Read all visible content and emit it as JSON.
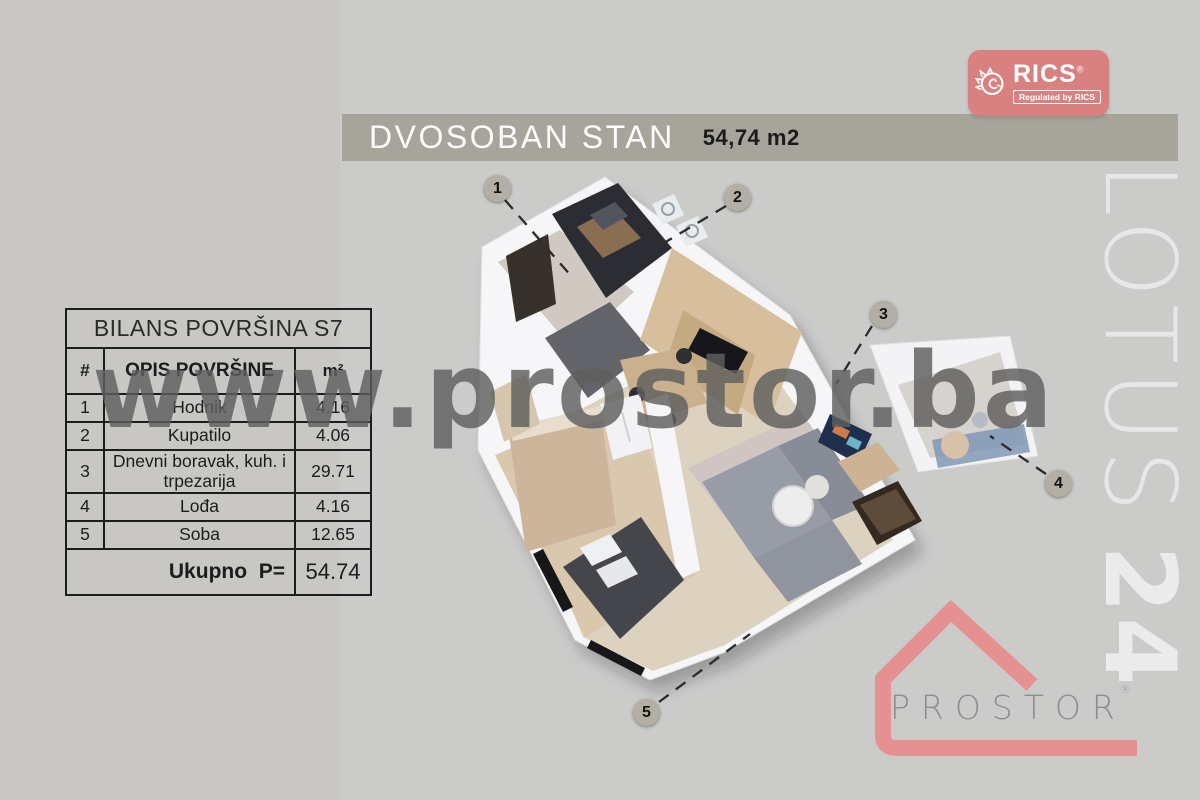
{
  "title_bar": {
    "title": "DVOSOBAN STAN",
    "area": "54,74 m2",
    "bar_color": "#a7a49c"
  },
  "rics_badge": {
    "brand": "RICS",
    "registered_mark": "®",
    "tagline": "Regulated by RICS",
    "color": "#d98181"
  },
  "watermark": {
    "text": "www.prostor.ba"
  },
  "side_label": {
    "word": "LOTUS",
    "number": "24"
  },
  "balance_table": {
    "title": "BILANS POVRŠINA S7",
    "columns": {
      "num": "#",
      "desc": "OPIS POVRŠINE",
      "unit": "m²"
    },
    "rows": [
      {
        "num": "1",
        "desc": "Hodnik",
        "value": "4.16"
      },
      {
        "num": "2",
        "desc": "Kupatilo",
        "value": "4.06"
      },
      {
        "num": "3",
        "desc": "Dnevni boravak, kuh. i trpezarija",
        "value": "29.71"
      },
      {
        "num": "4",
        "desc": "Lođa",
        "value": "4.16"
      },
      {
        "num": "5",
        "desc": "Soba",
        "value": "12.65"
      }
    ],
    "total_label": "Ukupno  P=",
    "total_value": "54.74"
  },
  "floor_plan": {
    "markers": [
      {
        "label": "1"
      },
      {
        "label": "2"
      },
      {
        "label": "3"
      },
      {
        "label": "4"
      },
      {
        "label": "5"
      }
    ],
    "marker_color": "#b4afa4"
  },
  "prostor_logo": {
    "brand": "PROSTOR",
    "registered_mark": "®",
    "accent": "#e59191"
  }
}
